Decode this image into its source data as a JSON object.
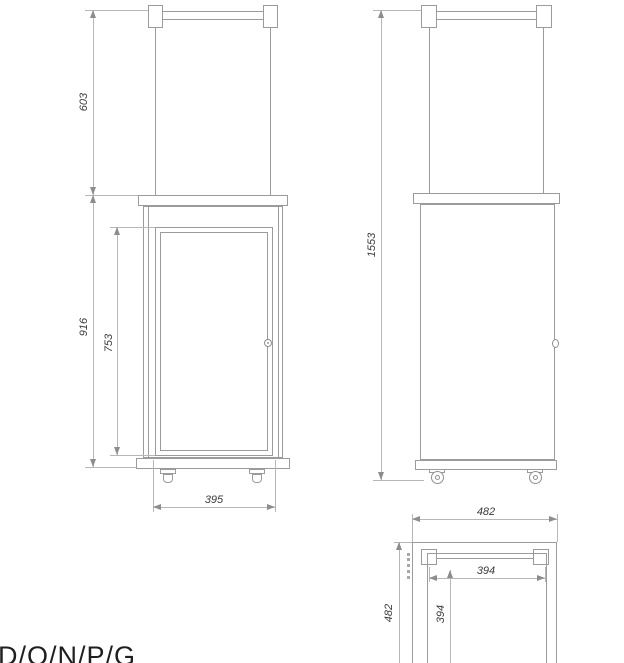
{
  "drawing": {
    "type": "technical-dimension-drawing",
    "subject": "glass-tube patio heater, three orthographic views",
    "colors": {
      "background": "#ffffff",
      "object_line": "#9b9b9b",
      "dimension_line": "#b7b7b7",
      "arrow": "#8d8d8d",
      "dim_text": "#3b3b3b",
      "footer_text": "#1f1f1f"
    },
    "dimensions": {
      "front": {
        "upper_section_height": "603",
        "body_height": "916",
        "door_height": "753",
        "door_width": "395"
      },
      "side": {
        "total_height": "1553"
      },
      "top": {
        "outer_width": "482",
        "outer_depth": "482",
        "inner_width": "394",
        "inner_depth": "394"
      }
    },
    "footer": {
      "partial_code": "D/O/N/P/G"
    }
  }
}
